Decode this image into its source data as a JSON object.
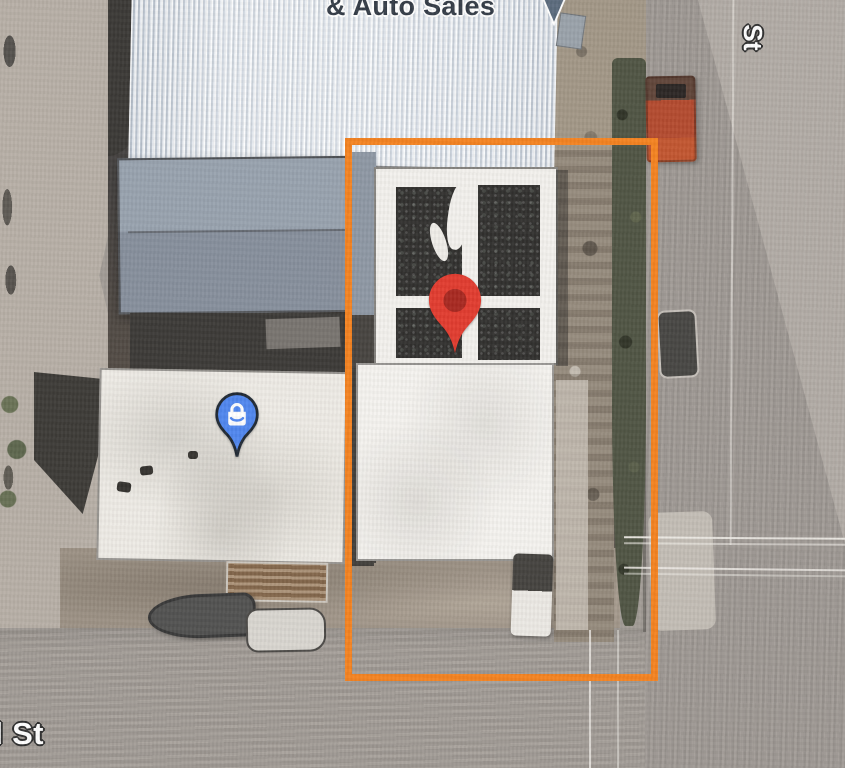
{
  "view": {
    "kind": "satellite-map",
    "highlight_color": "#F5821F"
  },
  "labels": {
    "place": "& Auto Sales",
    "street_right": "St",
    "street_bottom": "d St"
  },
  "markers": {
    "selected": {
      "icon": "red-pin-icon",
      "color": "#E23B2E",
      "inner_color": "#A8271F"
    },
    "shopping": {
      "icon": "shopping-bag-pin-icon",
      "color": "#4F86EF",
      "outline_color": "#1F2833",
      "glyph_color": "#FFFFFF"
    },
    "place_pointer": {
      "icon": "place-pointer-icon",
      "color": "#5B6B7D"
    }
  }
}
